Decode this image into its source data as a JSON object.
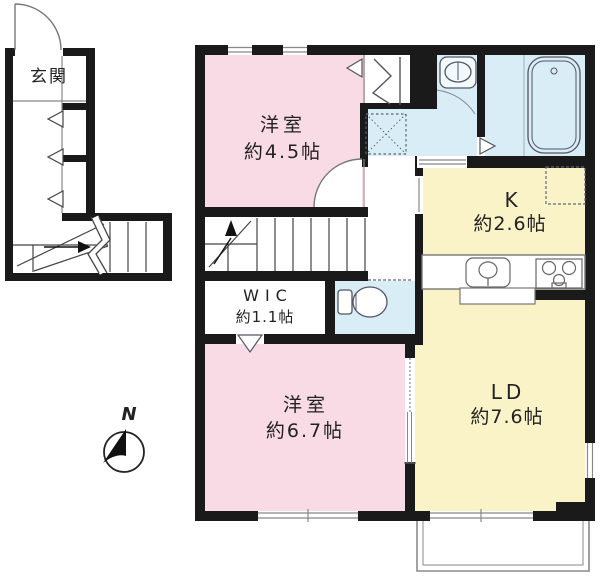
{
  "colors": {
    "wall": "#1a1a1a",
    "room_pink": "#f8dbe4",
    "room_yellow": "#fbf3c8",
    "room_blue": "#d8edf5",
    "line_gray": "#808080"
  },
  "rooms": {
    "genkan": {
      "label": "玄関"
    },
    "bedroom1": {
      "label": "洋室",
      "size": "約4.5帖"
    },
    "kitchen": {
      "label": "K",
      "size": "約2.6帖"
    },
    "wic": {
      "label": "WIC",
      "size": "約1.1帖"
    },
    "bedroom2": {
      "label": "洋室",
      "size": "約6.7帖"
    },
    "living_dining": {
      "label": "LD",
      "size": "約7.6帖"
    }
  },
  "compass": {
    "north_label": "N"
  },
  "fixtures": {
    "entrance_door": "entrance-door",
    "staircase_1f": "staircase-lower",
    "staircase_2f": "staircase-upper",
    "closet": "closet-hanger",
    "washbasin": "washbasin",
    "washing_machine_space": "washing-machine-space",
    "bathtub": "bathtub",
    "toilet": "toilet",
    "refrigerator_space": "refrigerator-space",
    "kitchen_sink": "kitchen-sink",
    "gas_stove": "gas-stove",
    "balcony": "balcony"
  }
}
